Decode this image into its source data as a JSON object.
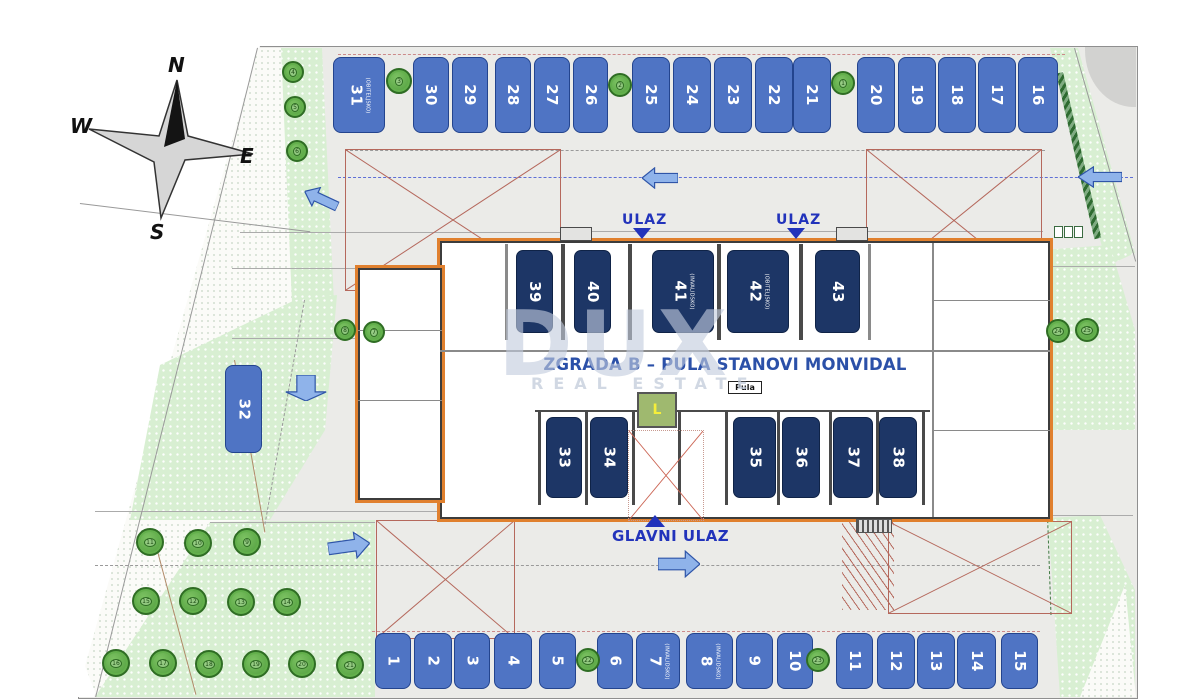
{
  "title": {
    "parts": [
      {
        "t": "Vanjska & garažna parkirna "
      },
      {
        "t": "mjesta",
        "cls": "wavy"
      },
      {
        "t": " / Outside & "
      },
      {
        "t": "garagge",
        "cls": "wavy"
      },
      {
        "t": " parking places"
      }
    ]
  },
  "compass": {
    "n": "N",
    "e": "E",
    "s": "S",
    "w": "W"
  },
  "watermark": {
    "line1": "DUX",
    "line2": "REAL ESTATE"
  },
  "building": {
    "name": "ZGRADA B – PULA STANOVI MONVIDAL",
    "pula_label": "Pula",
    "elevator_label": "L"
  },
  "entrances": {
    "ulaz1": "ULAZ",
    "ulaz2": "ULAZ",
    "main": "GLAVNI ULAZ"
  },
  "parking": {
    "top_row": [
      {
        "n": "31",
        "sub": "(OBITELJSKO)",
        "x": 333,
        "w": 52
      },
      {
        "n": "30",
        "x": 413,
        "w": 36
      },
      {
        "n": "29",
        "x": 452,
        "w": 36
      },
      {
        "n": "28",
        "x": 495,
        "w": 36
      },
      {
        "n": "27",
        "x": 534,
        "w": 36
      },
      {
        "n": "26",
        "x": 573,
        "w": 35
      },
      {
        "n": "25",
        "x": 632,
        "w": 38
      },
      {
        "n": "24",
        "x": 673,
        "w": 38
      },
      {
        "n": "23",
        "x": 714,
        "w": 38
      },
      {
        "n": "22",
        "x": 755,
        "w": 38
      },
      {
        "n": "21",
        "x": 793,
        "w": 38
      },
      {
        "n": "20",
        "x": 857,
        "w": 38
      },
      {
        "n": "19",
        "x": 898,
        "w": 38
      },
      {
        "n": "18",
        "x": 938,
        "w": 38
      },
      {
        "n": "17",
        "x": 978,
        "w": 38
      },
      {
        "n": "16",
        "x": 1018,
        "w": 40
      }
    ],
    "bottom_row": [
      {
        "n": "1",
        "x": 375,
        "w": 36
      },
      {
        "n": "2",
        "x": 414,
        "w": 38
      },
      {
        "n": "3",
        "x": 454,
        "w": 36
      },
      {
        "n": "4",
        "x": 494,
        "w": 38
      },
      {
        "n": "5",
        "x": 539,
        "w": 37
      },
      {
        "n": "6",
        "x": 597,
        "w": 36
      },
      {
        "n": "7",
        "sub": "(INVALIDSKO)",
        "x": 636,
        "w": 44
      },
      {
        "n": "8",
        "sub": "(INVALIDSKO)",
        "x": 686,
        "w": 47
      },
      {
        "n": "9",
        "x": 736,
        "w": 37
      },
      {
        "n": "10",
        "x": 777,
        "w": 36
      },
      {
        "n": "11",
        "x": 836,
        "w": 37
      },
      {
        "n": "12",
        "x": 877,
        "w": 38
      },
      {
        "n": "13",
        "x": 917,
        "w": 38
      },
      {
        "n": "14",
        "x": 957,
        "w": 39
      },
      {
        "n": "15",
        "x": 1001,
        "w": 37
      }
    ],
    "garage_upper": [
      {
        "n": "39",
        "x": 516,
        "w": 37
      },
      {
        "n": "40",
        "x": 574,
        "w": 37
      },
      {
        "n": "41",
        "sub": "(INVALIDSKO)",
        "x": 652,
        "w": 62
      },
      {
        "n": "42",
        "sub": "(OBITELJSKO)",
        "x": 727,
        "w": 62
      },
      {
        "n": "43",
        "x": 815,
        "w": 45
      }
    ],
    "garage_lower": [
      {
        "n": "33",
        "x": 546,
        "w": 36
      },
      {
        "n": "34",
        "x": 590,
        "w": 38
      },
      {
        "n": "35",
        "x": 733,
        "w": 43
      },
      {
        "n": "36",
        "x": 782,
        "w": 38
      },
      {
        "n": "37",
        "x": 833,
        "w": 40
      },
      {
        "n": "38",
        "x": 879,
        "w": 38
      }
    ],
    "mid_single": [
      {
        "n": "32",
        "x": 225,
        "w": 37
      }
    ]
  },
  "trees": [
    {
      "n": "3",
      "x": 386,
      "y": 68,
      "w": 26,
      "h": 26
    },
    {
      "n": "2",
      "x": 608,
      "y": 73,
      "w": 24,
      "h": 24
    },
    {
      "n": "1",
      "x": 831,
      "y": 71,
      "w": 24,
      "h": 24
    },
    {
      "n": "4",
      "x": 282,
      "y": 61,
      "w": 22,
      "h": 22
    },
    {
      "n": "5",
      "x": 284,
      "y": 96,
      "w": 22,
      "h": 22
    },
    {
      "n": "6",
      "x": 286,
      "y": 140,
      "w": 22,
      "h": 22
    },
    {
      "n": "8",
      "x": 334,
      "y": 319,
      "w": 22,
      "h": 22
    },
    {
      "n": "7",
      "x": 363,
      "y": 321,
      "w": 22,
      "h": 22
    },
    {
      "n": "11",
      "x": 136,
      "y": 528,
      "w": 28,
      "h": 28
    },
    {
      "n": "10",
      "x": 184,
      "y": 529,
      "w": 28,
      "h": 28
    },
    {
      "n": "9",
      "x": 233,
      "y": 528,
      "w": 28,
      "h": 28
    },
    {
      "n": "15",
      "x": 132,
      "y": 587,
      "w": 28,
      "h": 28
    },
    {
      "n": "12",
      "x": 179,
      "y": 587,
      "w": 28,
      "h": 28
    },
    {
      "n": "13",
      "x": 227,
      "y": 588,
      "w": 28,
      "h": 28
    },
    {
      "n": "14",
      "x": 273,
      "y": 588,
      "w": 28,
      "h": 28
    },
    {
      "n": "16",
      "x": 102,
      "y": 649,
      "w": 28,
      "h": 28
    },
    {
      "n": "17",
      "x": 149,
      "y": 649,
      "w": 28,
      "h": 28
    },
    {
      "n": "18",
      "x": 195,
      "y": 650,
      "w": 28,
      "h": 28
    },
    {
      "n": "19",
      "x": 242,
      "y": 650,
      "w": 28,
      "h": 28
    },
    {
      "n": "20",
      "x": 288,
      "y": 650,
      "w": 28,
      "h": 28
    },
    {
      "n": "21",
      "x": 336,
      "y": 651,
      "w": 28,
      "h": 28
    },
    {
      "n": "22",
      "x": 576,
      "y": 648,
      "w": 24,
      "h": 24
    },
    {
      "n": "23",
      "x": 806,
      "y": 648,
      "w": 24,
      "h": 24
    },
    {
      "n": "24",
      "x": 1046,
      "y": 319,
      "w": 24,
      "h": 24
    },
    {
      "n": "25",
      "x": 1075,
      "y": 318,
      "w": 24,
      "h": 24
    }
  ],
  "arrows": [
    {
      "x": 303,
      "y": 188,
      "w": 36,
      "h": 22,
      "rot": 25
    },
    {
      "x": 293,
      "y": 366,
      "w": 26,
      "h": 44,
      "rot": -90
    },
    {
      "x": 328,
      "y": 532,
      "w": 42,
      "h": 28,
      "rot": 172
    },
    {
      "x": 658,
      "y": 550,
      "w": 42,
      "h": 28,
      "rot": 180
    },
    {
      "x": 1078,
      "y": 166,
      "w": 44,
      "h": 22
    },
    {
      "x": 642,
      "y": 167,
      "w": 36,
      "h": 22
    }
  ],
  "dimensions": [
    {
      "t": "9.77",
      "x": 300,
      "y": 220
    },
    {
      "t": "19.27",
      "x": 248,
      "y": 233,
      "rot": -7
    },
    {
      "t": "8.75",
      "x": 296,
      "y": 258
    },
    {
      "t": "19.03",
      "x": 258,
      "y": 301,
      "rot": -7
    },
    {
      "t": "8.65",
      "x": 264,
      "y": 329
    },
    {
      "t": "19.1",
      "x": 190,
      "y": 396,
      "rot": -7
    },
    {
      "t": "18.54",
      "x": 242,
      "y": 483,
      "rot": -5
    },
    {
      "t": "13.88",
      "x": 248,
      "y": 503
    },
    {
      "t": "19.01",
      "x": 144,
      "y": 517,
      "rot": -5
    },
    {
      "t": "36.85",
      "x": 700,
      "y": 218
    },
    {
      "t": "42,30",
      "x": 686,
      "y": 328
    },
    {
      "t": "40.75",
      "x": 688,
      "y": 502,
      "cls": "b"
    },
    {
      "t": "17.70",
      "x": 726,
      "y": 508
    },
    {
      "t": "17.52",
      "x": 841,
      "y": 391,
      "rot": -6
    },
    {
      "t": "17.22",
      "x": 960,
      "y": 358,
      "rot": -8
    },
    {
      "t": "18.02",
      "x": 492,
      "y": 438,
      "rot": -7
    },
    {
      "t": "18.2",
      "x": 1096,
      "y": 148,
      "rot": -12
    },
    {
      "t": "3.02",
      "x": 1054,
      "y": 256
    },
    {
      "t": "3.24",
      "x": 1064,
      "y": 330
    },
    {
      "t": "4.23",
      "x": 1070,
      "y": 503
    },
    {
      "t": "5.50",
      "x": 1008,
      "y": 552,
      "rot": -90
    },
    {
      "t": "11.60",
      "x": 1028,
      "y": 580,
      "rot": -90
    },
    {
      "t": "6.95",
      "x": 536,
      "y": 556,
      "rot": -90
    },
    {
      "t": "6.95",
      "x": 724,
      "y": 556,
      "rot": -90
    },
    {
      "t": "5.50",
      "x": 434,
      "y": 158,
      "rot": -90
    },
    {
      "t": "1.50",
      "x": 400,
      "y": 132,
      "rot": -90
    },
    {
      "t": "7.00",
      "x": 742,
      "y": 162,
      "rot": -90
    },
    {
      "t": "4.50",
      "x": 288,
      "y": 374,
      "rot": -90
    },
    {
      "t": "16.00",
      "x": 1026,
      "y": 352,
      "rot": -90
    }
  ],
  "fire_texts": [
    {
      "t": "površina za rad vatrogasnog vozila",
      "x": 352,
      "y": 166
    },
    {
      "t": "pad terena max 10%",
      "x": 352,
      "y": 182
    },
    {
      "t": "dim 5,5m x 11m",
      "x": 352,
      "y": 190
    },
    {
      "t": "površina za rad vatrogasnog vozila",
      "x": 880,
      "y": 153
    },
    {
      "t": "pad terena max 10%",
      "x": 880,
      "y": 169
    },
    {
      "t": "dim 5,5m x 11m",
      "x": 880,
      "y": 177
    },
    {
      "t": "površina za rad vatrogasnog vozila",
      "x": 898,
      "y": 538
    },
    {
      "t": "pad terena max 10%",
      "x": 898,
      "y": 554
    },
    {
      "t": "dim 5,5m x 11m",
      "x": 898,
      "y": 562
    },
    {
      "t": "površina za rad vatrogasnog vozila",
      "x": 546,
      "y": 518
    }
  ],
  "fire_rects": [
    {
      "x": 345,
      "y": 149,
      "w": 214,
      "h": 140
    },
    {
      "x": 866,
      "y": 149,
      "w": 174,
      "h": 141
    },
    {
      "x": 376,
      "y": 520,
      "w": 137,
      "h": 117
    },
    {
      "x": 888,
      "y": 521,
      "w": 182,
      "h": 91
    }
  ],
  "lines": [
    {
      "x": 240,
      "y": 232,
      "w": 320
    },
    {
      "x": 232,
      "y": 268,
      "w": 245
    },
    {
      "x": 232,
      "y": 338,
      "w": 330
    },
    {
      "x": 95,
      "y": 511,
      "w": 468
    },
    {
      "x": 565,
      "y": 231,
      "w": 478
    },
    {
      "x": 540,
      "y": 513,
      "w": 505
    },
    {
      "x": 1040,
      "y": 266,
      "w": 95
    },
    {
      "x": 1045,
      "y": 515,
      "w": 88
    },
    {
      "x": 210,
      "y": 522,
      "w": 165
    },
    {
      "x": 338,
      "y": 54,
      "w": 727,
      "cls": "reddash"
    },
    {
      "x": 372,
      "y": 631,
      "w": 668,
      "cls": "reddash"
    },
    {
      "x": 338,
      "y": 177,
      "w": 795,
      "cls": "bluedash"
    },
    {
      "x": 345,
      "y": 150,
      "w": 700,
      "cls": "dash"
    },
    {
      "x": 95,
      "y": 565,
      "w": 945,
      "cls": "dash"
    },
    {
      "x": 258,
      "y": 48,
      "w": 669,
      "rot": 104,
      "cls": "bound"
    },
    {
      "x": 80,
      "y": 203,
      "w": 232,
      "rot": 7,
      "cls": "bound"
    },
    {
      "x": 1075,
      "y": 48,
      "w": 222,
      "rot": 74,
      "cls": "bound"
    },
    {
      "x": 1063,
      "y": 72,
      "w": 170,
      "rot": 77,
      "cls": "hedge"
    },
    {
      "x": 1048,
      "y": 515,
      "w": 100,
      "rot": 88,
      "cls": "dashgreen"
    },
    {
      "x": 305,
      "y": 300,
      "w": 228,
      "rot": 100,
      "cls": "dash"
    },
    {
      "x": 155,
      "y": 540,
      "w": 160,
      "rot": 75,
      "cls": "brown"
    },
    {
      "x": 235,
      "y": 360,
      "w": 175,
      "rot": 80,
      "cls": "brown"
    }
  ]
}
